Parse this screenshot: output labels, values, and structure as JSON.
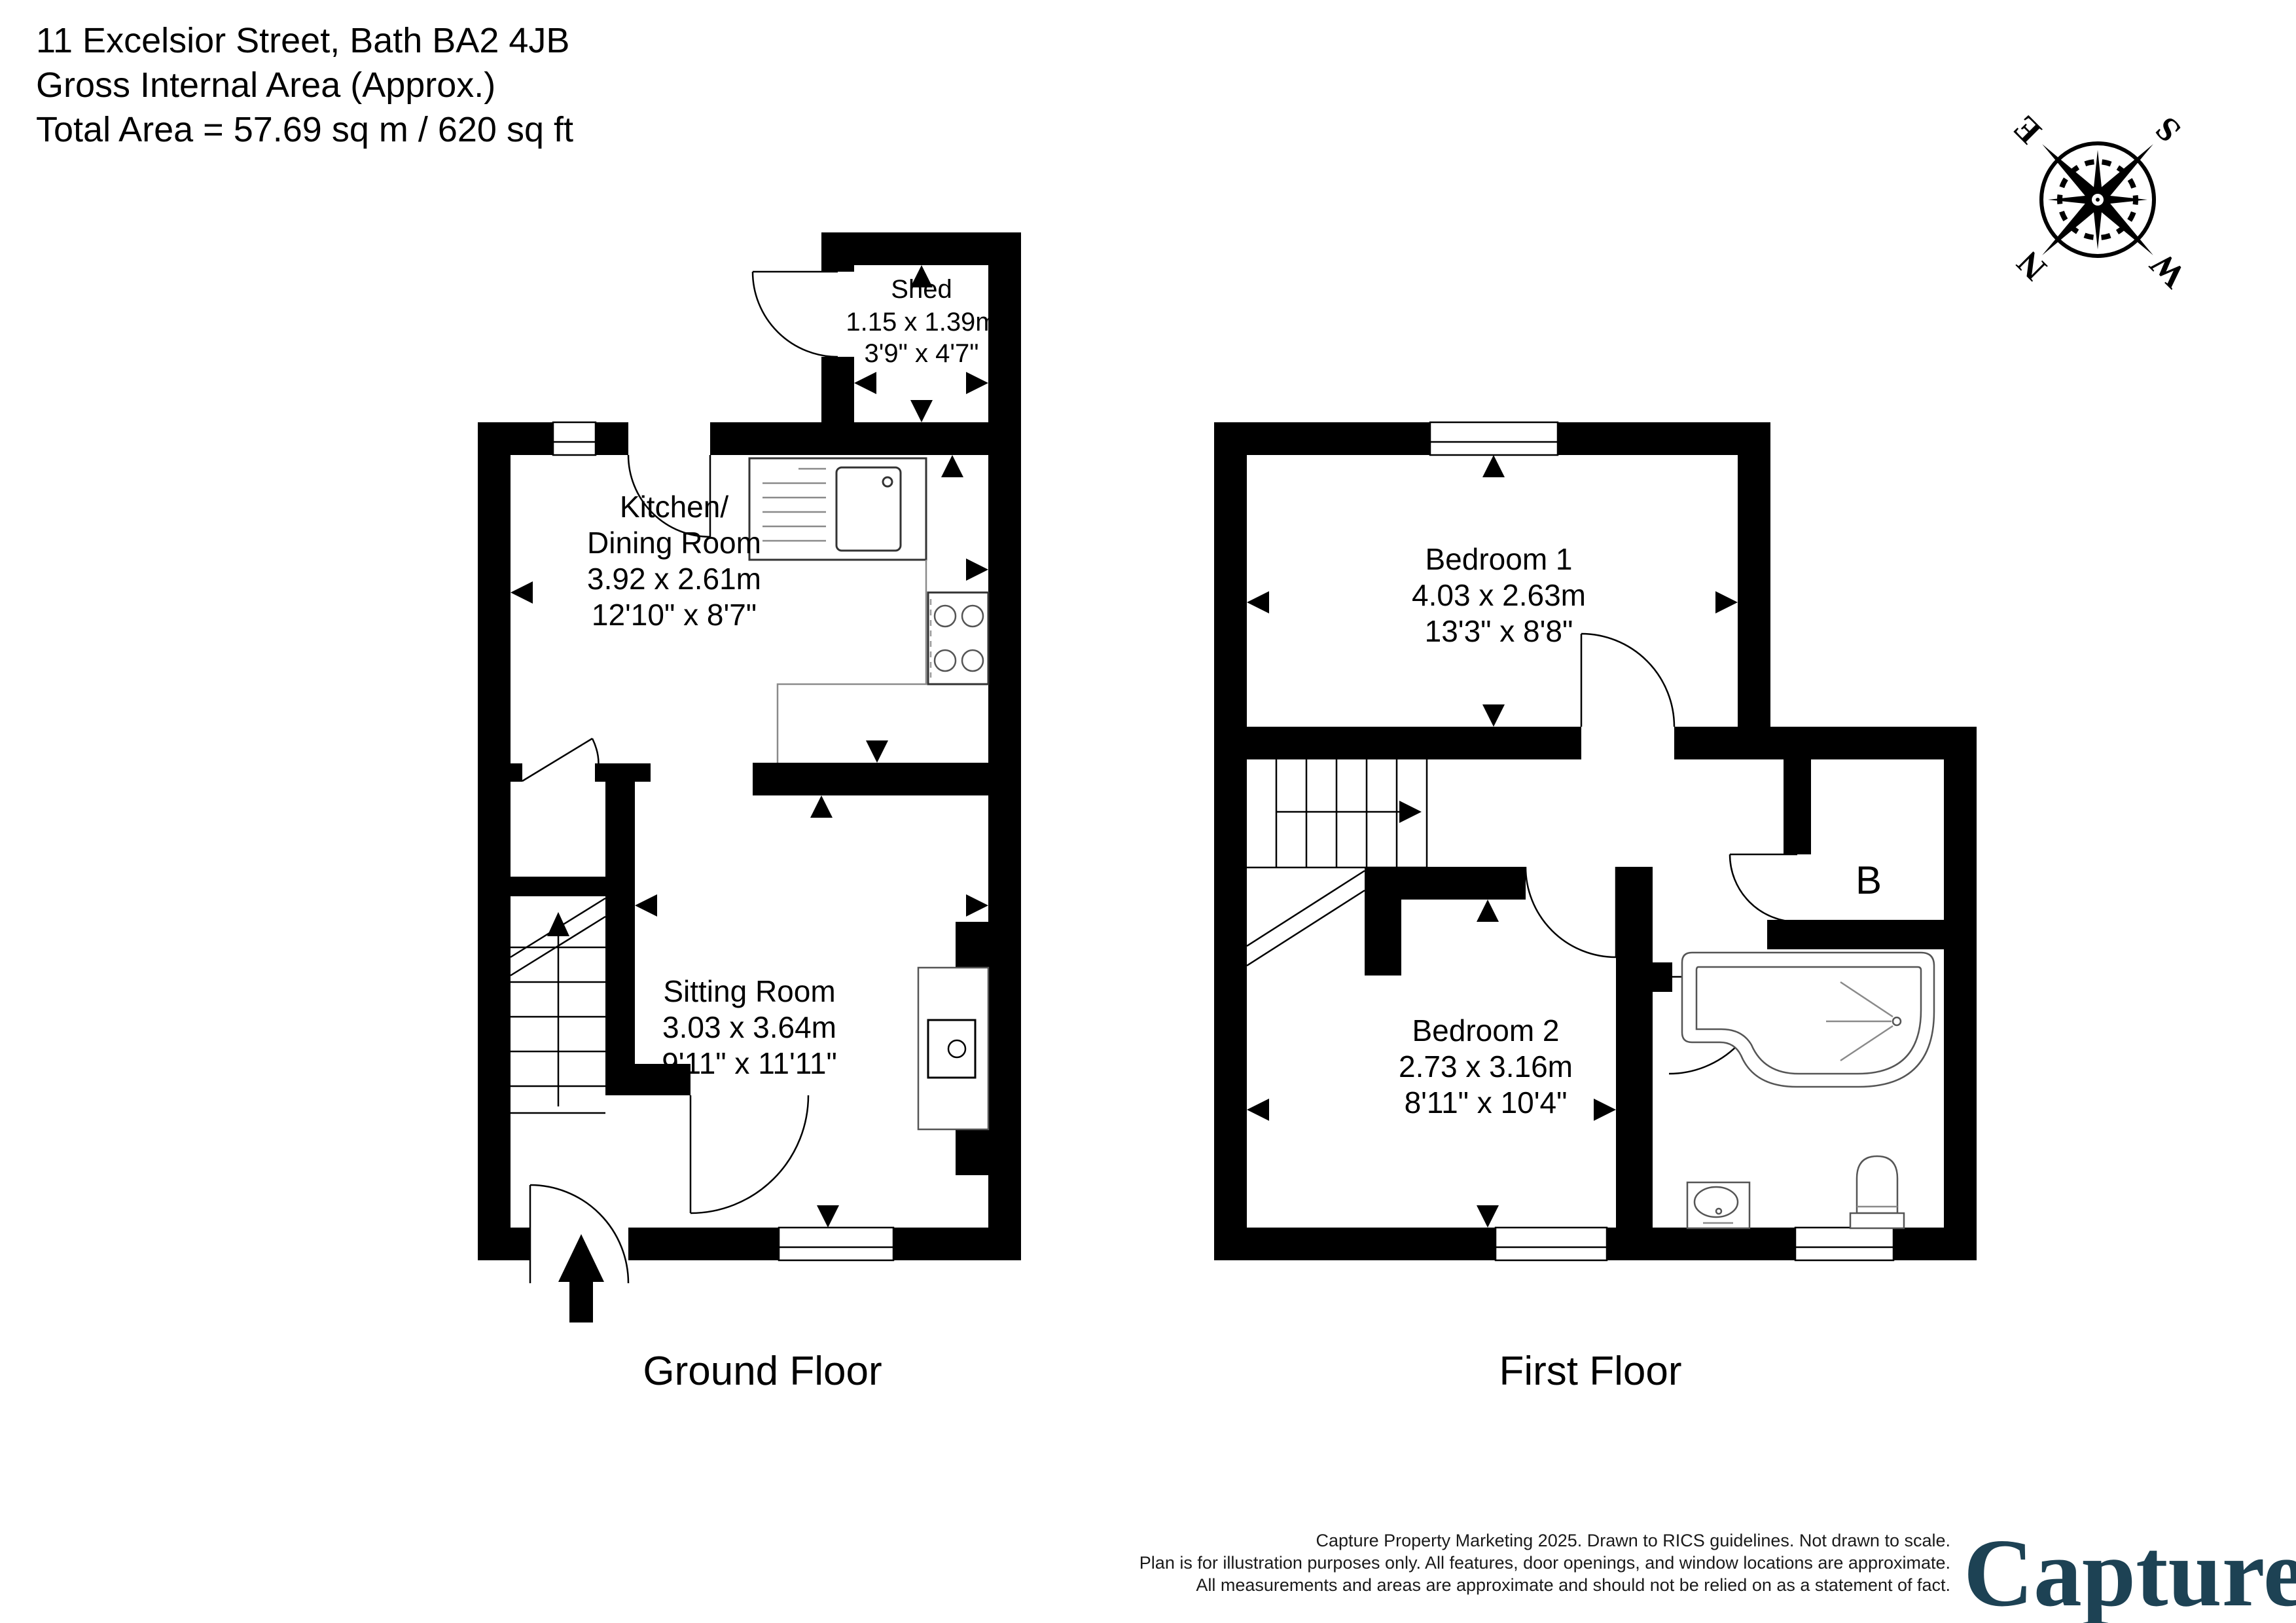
{
  "header": {
    "line1": "11 Excelsior Street, Bath BA2 4JB",
    "line2": "Gross Internal Area (Approx.)",
    "line3": "Total Area = 57.69 sq m / 620 sq ft"
  },
  "compass": {
    "n": "N",
    "e": "E",
    "s": "S",
    "w": "W"
  },
  "ground_floor": {
    "caption": "Ground Floor",
    "shed": {
      "name": "Shed",
      "metric": "1.15 x 1.39m",
      "imperial": "3'9\" x 4'7\""
    },
    "kitchen": {
      "name_line1": "Kitchen/",
      "name_line2": "Dining Room",
      "metric": "3.92 x 2.61m",
      "imperial": "12'10\" x 8'7\""
    },
    "sitting_room": {
      "name": "Sitting Room",
      "metric": "3.03 x 3.64m",
      "imperial": "9'11\" x 11'11\""
    }
  },
  "first_floor": {
    "caption": "First Floor",
    "bedroom1": {
      "name": "Bedroom 1",
      "metric": "4.03 x 2.63m",
      "imperial": "13'3\" x 8'8\""
    },
    "bedroom2": {
      "name": "Bedroom 2",
      "metric": "2.73 x 3.16m",
      "imperial": "8'11\" x 10'4\""
    },
    "cupboard_label": "B"
  },
  "footer": {
    "disclaimer": [
      "Capture Property Marketing 2025. Drawn to RICS guidelines.  Not drawn to scale.",
      "Plan is for illustration purposes only. All features, door openings, and window locations are approximate.",
      "All measurements and areas are approximate and should not be relied on as a statement of fact."
    ],
    "logo_text": "Capture",
    "logo_dot": "."
  },
  "colors": {
    "wall": "#000000",
    "fixture": "#555555",
    "logo_navy": "#1d4254",
    "logo_pink": "#d5155e"
  }
}
